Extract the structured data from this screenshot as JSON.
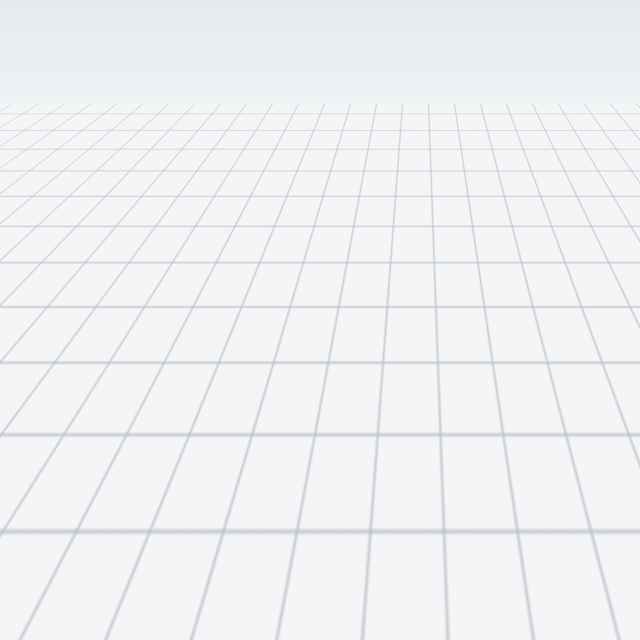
{
  "viewport": {
    "type": "3d-floorplan-render",
    "background": "empty white workspace with perspective grid floor",
    "grid_color": "#bac0c6",
    "sky_top_color": "#e7eaed"
  },
  "apartment": {
    "wall_color": "#f5f6f7",
    "led_strip_color": "#7aa3dc",
    "trim_color": "#121416",
    "rooms": [
      {
        "name": "gallery-room",
        "wall": "#a3a8ab",
        "items": [
          "picture-frames",
          "white-desk",
          "dark-wardrobe"
        ]
      },
      {
        "name": "closet-room-left",
        "floor": "#f1f3f3",
        "items": []
      },
      {
        "name": "closet-room-right",
        "floor": "#f1f3f3",
        "items": []
      },
      {
        "name": "pink-bedroom",
        "floor": "#e8cdc5",
        "accent": "#2f5450",
        "items": [
          "dresser",
          "hexagon-lamp",
          "tv-waterfall",
          "wood-floor-strip"
        ]
      },
      {
        "name": "bathroom",
        "floor": "#fbfbfb",
        "accent": "#85aede",
        "items": [
          "bath-mat",
          "toilet",
          "bathtub"
        ]
      },
      {
        "name": "study-room",
        "floor": "#efe8da",
        "items": [
          "wardrobe-doors",
          "orange-desk",
          "white-chair"
        ]
      },
      {
        "name": "water-closet",
        "floor": "#5d93a6",
        "items": []
      },
      {
        "name": "empty-room",
        "floor": "#f3f4f5",
        "items": []
      },
      {
        "name": "mural-room",
        "mural": "city skyline at dusk",
        "mural_sky": "#5e97cd",
        "items": [
          "city-mural",
          "classical-molding-walls",
          "bookshelf"
        ]
      },
      {
        "name": "living-room",
        "floor": "#a6a8aa",
        "items": [
          "marble-tv-wall",
          "tv-waterfall",
          "media-console",
          "chandelier",
          "curved-sofa",
          "coffee-table",
          "rug",
          "teal-panel",
          "mustard-cabinet",
          "glass-partition"
        ]
      },
      {
        "name": "dining-room",
        "floor": "#b2b4b6",
        "items": [
          "glass-partition-frames",
          "ceiling-light-panels",
          "marble-oval-table",
          "white-chairs",
          "black-chandelier",
          "red-bowl",
          "plant",
          "kitchen-cabinets"
        ]
      }
    ],
    "palette": {
      "pink": "#e8cdc5",
      "teal_dark": "#2f5450",
      "mustard": "#cf9c3f",
      "orange_cabinet": "#cf6a2a",
      "marble": "#f2f2f2",
      "sofa_black": "#232527",
      "mural_blue": "#3f6f9f",
      "red_bowl": "#7a1f28"
    }
  }
}
